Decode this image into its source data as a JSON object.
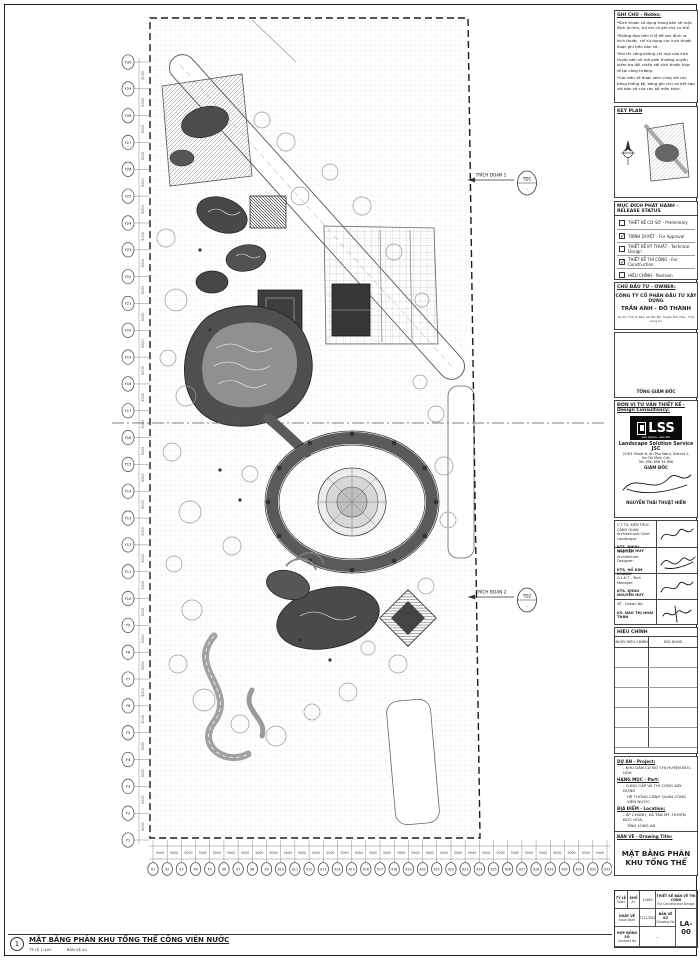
{
  "notes": {
    "title": "GHI CHÚ - Notes:",
    "items": [
      "*Kích thước sử dụng trong bản vẽ mặc định là mm, trừ khi có ghi chú cụ thể.",
      "*Không dựa trên tỉ lệ để xác định ra kích thước, chỉ sử dụng các kích thước được ghi trên bản vẽ.",
      "*Khi thi công không chỉ dựa vào kích thước bản vẽ mà phải thường xuyên kiểm tra đối chiếu với kích thước thực tế tại công trường.",
      "*Các bản vẽ được xem cùng với các bảng thống kê, bảng ghi chú và kết hợp với bản vẽ của các bộ môn khác."
    ]
  },
  "key_plan": {
    "title": "KEY PLAN"
  },
  "release": {
    "title": "MỤC ĐÍCH PHÁT HÀNH - RELEASE STATUS",
    "items": [
      {
        "label": "THIẾT KẾ CƠ SỞ - Preliminary",
        "checked": false
      },
      {
        "label": "TRÌNH DUYỆT - For Approval",
        "checked": true
      },
      {
        "label": "THIẾT KẾ KỸ THUẬT - Technical Design",
        "checked": false
      },
      {
        "label": "THIẾT KẾ THI CÔNG - For Construction",
        "checked": true
      },
      {
        "label": "HIỆU CHỈNH - Revision",
        "checked": false
      }
    ]
  },
  "owner": {
    "title": "CHỦ ĐẦU TƯ - OWNER:",
    "company_line1": "CÔNG TY CỔ PHẦN ĐẦU TƯ XÂY DỰNG",
    "company_line2": "TRẦN ANH - ĐÔ THÀNH",
    "address": "Ấp 4C, Tỉnh lộ 824, Xã Tân Mỹ, Huyện Đức Hòa - Tỉnh Long An",
    "sign_title": "TỔNG GIÁM ĐỐC"
  },
  "consultant": {
    "title": "ĐƠN VỊ TƯ VẤN THIẾT KẾ - Design Consultancy:",
    "logo_text": "LSS",
    "logo_tagline": "see green...see life",
    "company": "Landscape Solution Service JSC",
    "address1": "219/3 Street 8, An Phu Ward, District 2,",
    "address2": "Ho Chi Minh City",
    "tel": "Tel: (08) 898 54 698",
    "sign_title": "GIÁM ĐỐC",
    "sign_name": "NGUYỄN THÁI THUẬT HIỀN"
  },
  "signers": [
    {
      "role1": "C.T TK. KIẾN TRÚC CẢNH QUAN",
      "role2": "Architectural Chief Landscape:",
      "name": "KTS. KHUU NGUYỄN HUY"
    },
    {
      "role1": "THIẾT KẾ - Architecture Designer:",
      "role2": "",
      "name": "KTS. HỒ KIM KHÁNH"
    },
    {
      "role1": "Q.L.K.T - Tech Manager:",
      "role2": "",
      "name": "KTS. KHUU NGUYỄN HUY"
    },
    {
      "role1": "VẼ - Drawn By:",
      "role2": "",
      "name": "KS. ĐÀO THỊ HOÀI THÂN"
    }
  ],
  "revision": {
    "title": "HIỆU CHỈNH",
    "col1": "NGÀY HIỆU CHỈNH",
    "col2": "NỘI DUNG",
    "empty_rows": 5
  },
  "project": {
    "label": "DỰ ÁN - Project:",
    "name": "-   KHU DÂN CƯ ĐÔ THỊ HUYỆN ĐỨC HÒA",
    "part_label": "HẠNG MỤC - Part:",
    "part1": "-   CUNG CẤP VÀ THI CÔNG XÂY DỰNG",
    "part2": "HỆ THỐNG CẢNH QUAN CÔNG VIÊN NƯỚC",
    "loc_label": "ĐỊA ĐIỂM - Location:",
    "loc1": "-   ẤP CHÁNH, XÃ TÂN MỸ, HUYỆN ĐỨC HÒA,",
    "loc2": "TỈNH LONG AN",
    "title_label": "BẢN VẼ - Drawing Title:",
    "drawing_title": "MẶT BẰNG PHÂN KHU TỔNG THỂ"
  },
  "titletable": {
    "scale_label": "TỶ LỆ",
    "scale_en": "Scale",
    "scale_value": "1/400",
    "size_label": "KHỔ",
    "size_value": "A1",
    "status_vi": "THIẾT KẾ BẢN VẼ THI CÔNG",
    "status_en": "For Construction Design",
    "date_label": "NGÀY VẼ",
    "date_en": "Issue Date",
    "date_value": "07/12/2021",
    "dwg_label": "BẢN VẼ SỐ",
    "dwg_en": "Drawing No",
    "dwg_value": "-",
    "contract_label": "HỢP ĐỒNG SỐ",
    "contract_en": "Contract No",
    "contract_value": "...",
    "sheet_no": "LA-00"
  },
  "plan": {
    "callout1_label": "TRÍCH ĐOẠN 1",
    "callout1_bubble": "TĐ1",
    "callout1_sub": "-",
    "callout2_label": "TRÍCH ĐOẠN 2",
    "callout2_bubble": "TĐ2",
    "callout2_sub": "-",
    "axis_bottom": {
      "dim": "5000",
      "labels": [
        "X1",
        "X2",
        "X3",
        "X4",
        "X5",
        "X6",
        "X7",
        "X8",
        "X9",
        "X10",
        "X11",
        "X12",
        "X13",
        "X14",
        "X15",
        "X16",
        "X17",
        "X18",
        "X19",
        "X20",
        "X21",
        "X22",
        "X23",
        "X24",
        "X25",
        "X26",
        "X27",
        "X28",
        "X29",
        "X30",
        "X31",
        "X32",
        "X33"
      ]
    },
    "axis_left": {
      "dim": "5000",
      "labels": [
        "Y30",
        "Y29",
        "Y28",
        "Y27",
        "Y26",
        "Y25",
        "Y24",
        "Y23",
        "Y22",
        "Y21",
        "Y20",
        "Y19",
        "Y18",
        "Y17",
        "Y16",
        "Y15",
        "Y14",
        "Y13",
        "Y12",
        "Y11",
        "Y10",
        "Y9",
        "Y8",
        "Y7",
        "Y6",
        "Y5",
        "Y4",
        "Y3",
        "Y2",
        "Y1"
      ]
    }
  },
  "footer": {
    "num": "1",
    "title": "MẶT BẰNG PHÂN KHU TỔNG THỂ CÔNG VIÊN NƯỚC",
    "scale": "TỶ LỆ 1:400",
    "size": "BẢN VẼ A1"
  },
  "colors": {
    "line": "#333333",
    "pool_dark": "#4a4a4a",
    "pool_light": "#9b9b9b",
    "paper": "#ffffff"
  }
}
